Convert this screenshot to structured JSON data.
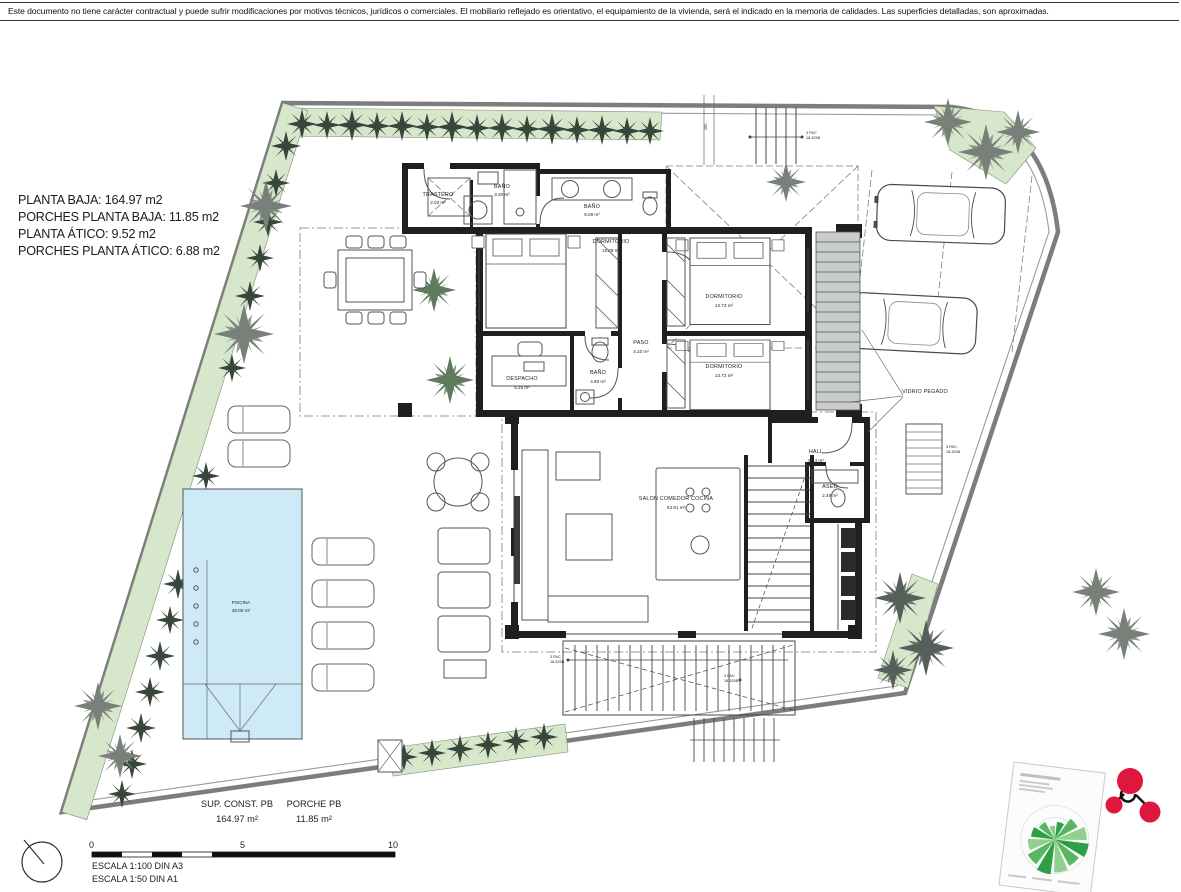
{
  "disclaimer": "Este documento no tiene carácter contractual y puede sufrir modificaciones por motivos técnicos, jurídicos o comerciales. El mobiliario reflejado es orientativo, el equipamiento de la vivienda, será el indicado en la memoria de calidades. Las superficies detalladas, son aproximadas.",
  "area_summary": {
    "line1": "PLANTA BAJA: 164.97 m2",
    "line2": "PORCHES PLANTA BAJA: 11.85 m2",
    "line3": "PLANTA ÁTICO: 9.52 m2",
    "line4": "PORCHES PLANTA ÁTICO: 6.88 m2"
  },
  "rooms": [
    {
      "name": "TRASTERO",
      "area": "2.03 m²"
    },
    {
      "name": "BAÑO",
      "area": "3.30 m²"
    },
    {
      "name": "BAÑO",
      "area": "6.08 m²"
    },
    {
      "name": "DORMITORIO",
      "area": "15.28 m²"
    },
    {
      "name": "DORMITORIO",
      "area": "13.73 m²"
    },
    {
      "name": "DORMITORIO",
      "area": "13.73 m²"
    },
    {
      "name": "PASO",
      "area": "4.10 m²"
    },
    {
      "name": "DESPACHO",
      "area": "8.25 m²"
    },
    {
      "name": "BAÑO",
      "area": "4.80 m²"
    },
    {
      "name": "HALL",
      "area": "5.44 m²"
    },
    {
      "name": "ASEO",
      "area": "2.49 m²"
    },
    {
      "name": "SALON COMEDOR COCINA",
      "area": "53.81 m²"
    },
    {
      "name": "PISCINA",
      "area": "30.00 m²"
    }
  ],
  "annotations": {
    "vidrio_pegado": "VIDRIO PEGADO",
    "stair_dim_line1": "3 PAC",
    "stair_dim_line2": "18.325B",
    "dim_250": "250"
  },
  "footer": {
    "sup_const_label": "SUP. CONST. PB",
    "sup_const_value": "164.97 m²",
    "porche_label": "PORCHE PB",
    "porche_value": "11.85 m²"
  },
  "scale_bar": {
    "tick_0": "0",
    "tick_5": "5",
    "tick_10": "10",
    "escala_line1": "ESCALA 1:100 DIN A3",
    "escala_line2": "ESCALA 1:50 DIN A1"
  },
  "logo": {
    "wind_rose": {
      "wedge_radii": [
        18,
        26,
        32,
        34,
        30,
        33,
        35,
        31,
        27,
        24,
        20,
        14
      ],
      "colors": [
        "#2f9e44",
        "#57b65f",
        "#8fd08f"
      ]
    }
  },
  "colors": {
    "wall": "#1f1f1f",
    "boundary": "#7d7d7d",
    "hedge": "#d7e7cb",
    "shrub": "#36463a",
    "palm": "#79807a",
    "pool": "#cdeaf6",
    "line": "#555555",
    "logo_red": "#e0173c"
  }
}
